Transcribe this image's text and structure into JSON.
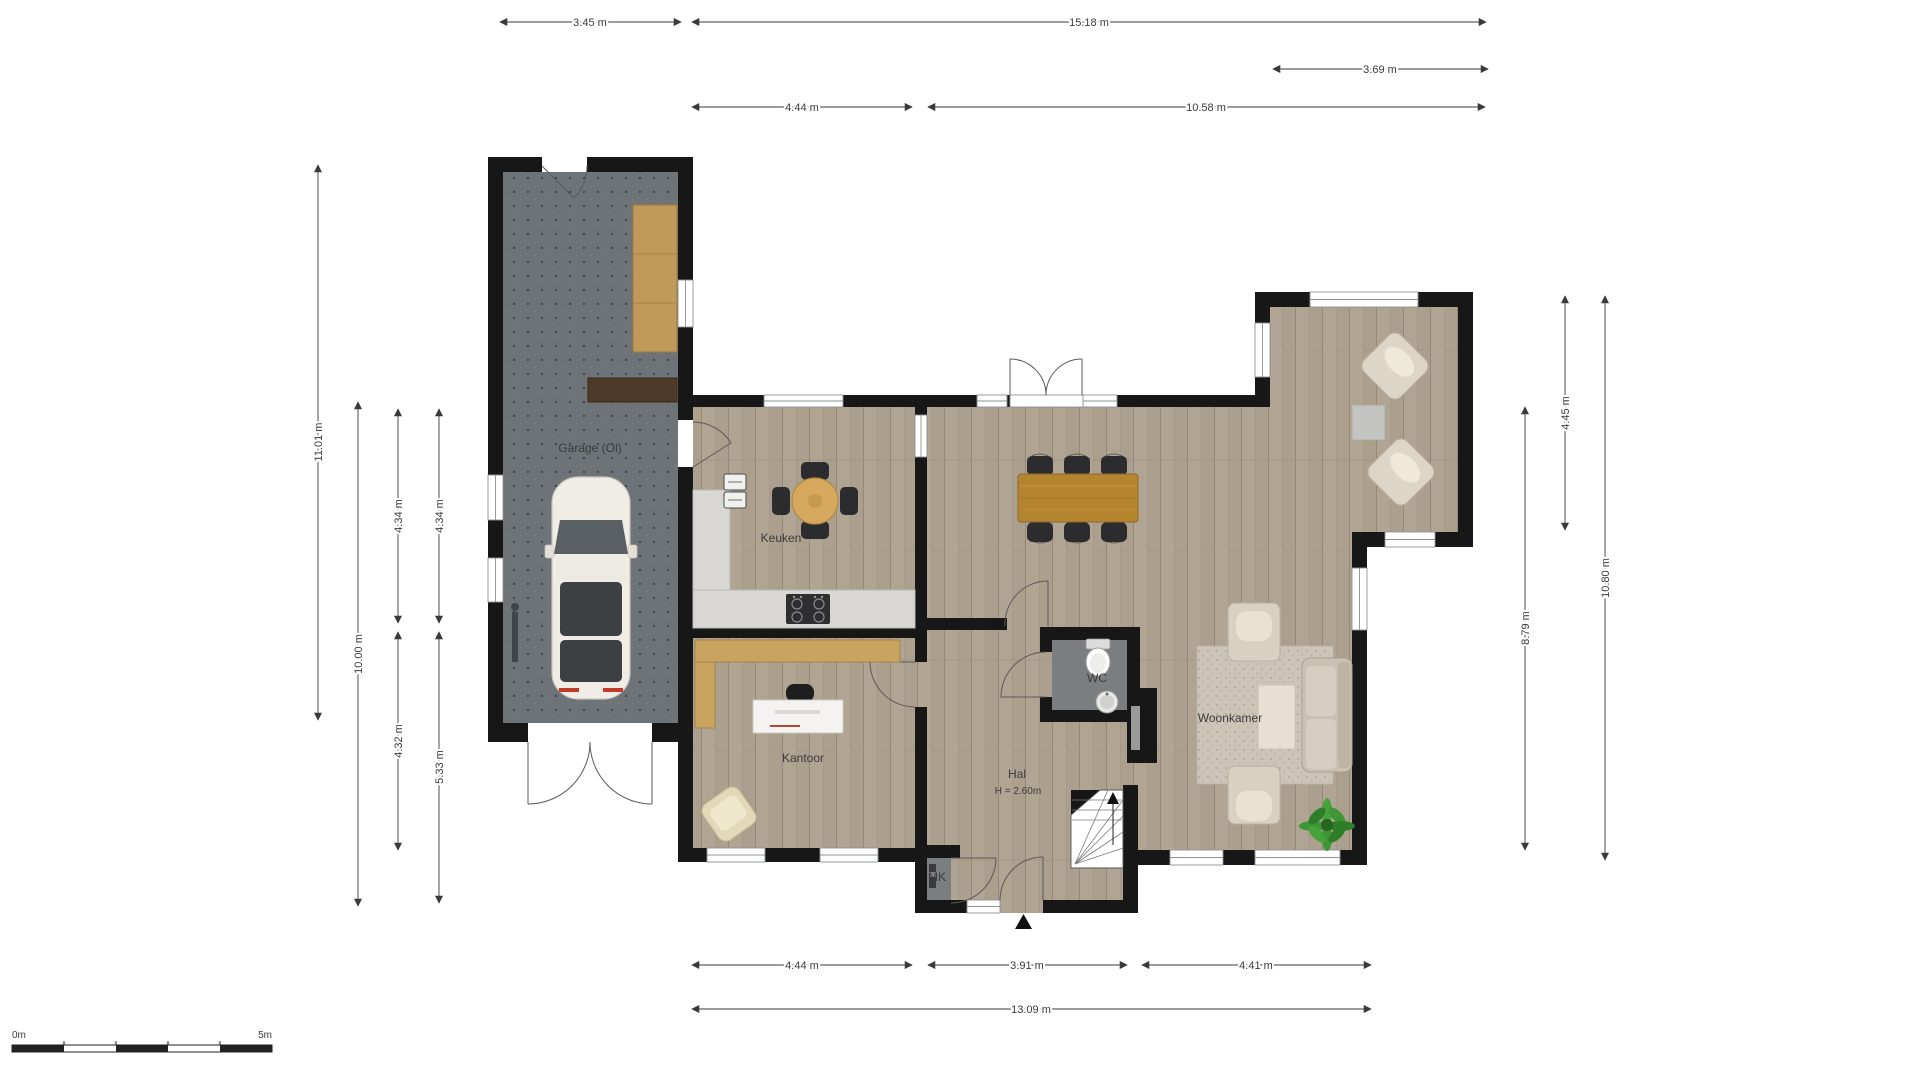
{
  "rooms": {
    "garage": "Garage (Ol)",
    "keuken": "Keuken",
    "kantoor": "Kantoor",
    "hal": "Hal",
    "hal_height": "H = 2.60m",
    "wc": "WC",
    "woonkamer": "Woonkamer",
    "mk": "MK"
  },
  "dims": {
    "t1": "3.45 m",
    "t2": "15.18 m",
    "t3": "3.69 m",
    "t4": "4.44 m",
    "t5": "10.58 m",
    "l1": "11.01 m",
    "l2": "10.00 m",
    "l3": "4.34 m",
    "l4": "4.34 m",
    "l5": "4.32 m",
    "l6": "5.33 m",
    "r1": "8.79 m",
    "r2": "4.45 m",
    "r3": "10.80 m",
    "b1": "4.44 m",
    "b2": "3.91 m",
    "b3": "4.41 m",
    "b4": "13.09 m"
  },
  "scale_bar": {
    "start": "0m",
    "end": "5m"
  },
  "colors": {
    "wall": "#171717",
    "wood_floor": "#ab9f8d",
    "garage_floor": "#6d7376",
    "wc_floor": "#7b7e80",
    "counter": "#d8d7d3",
    "wood_furniture": "#c09a58",
    "table_wood": "#b5842f",
    "rug": "#cbc4b7",
    "plant": "#3e9636"
  }
}
